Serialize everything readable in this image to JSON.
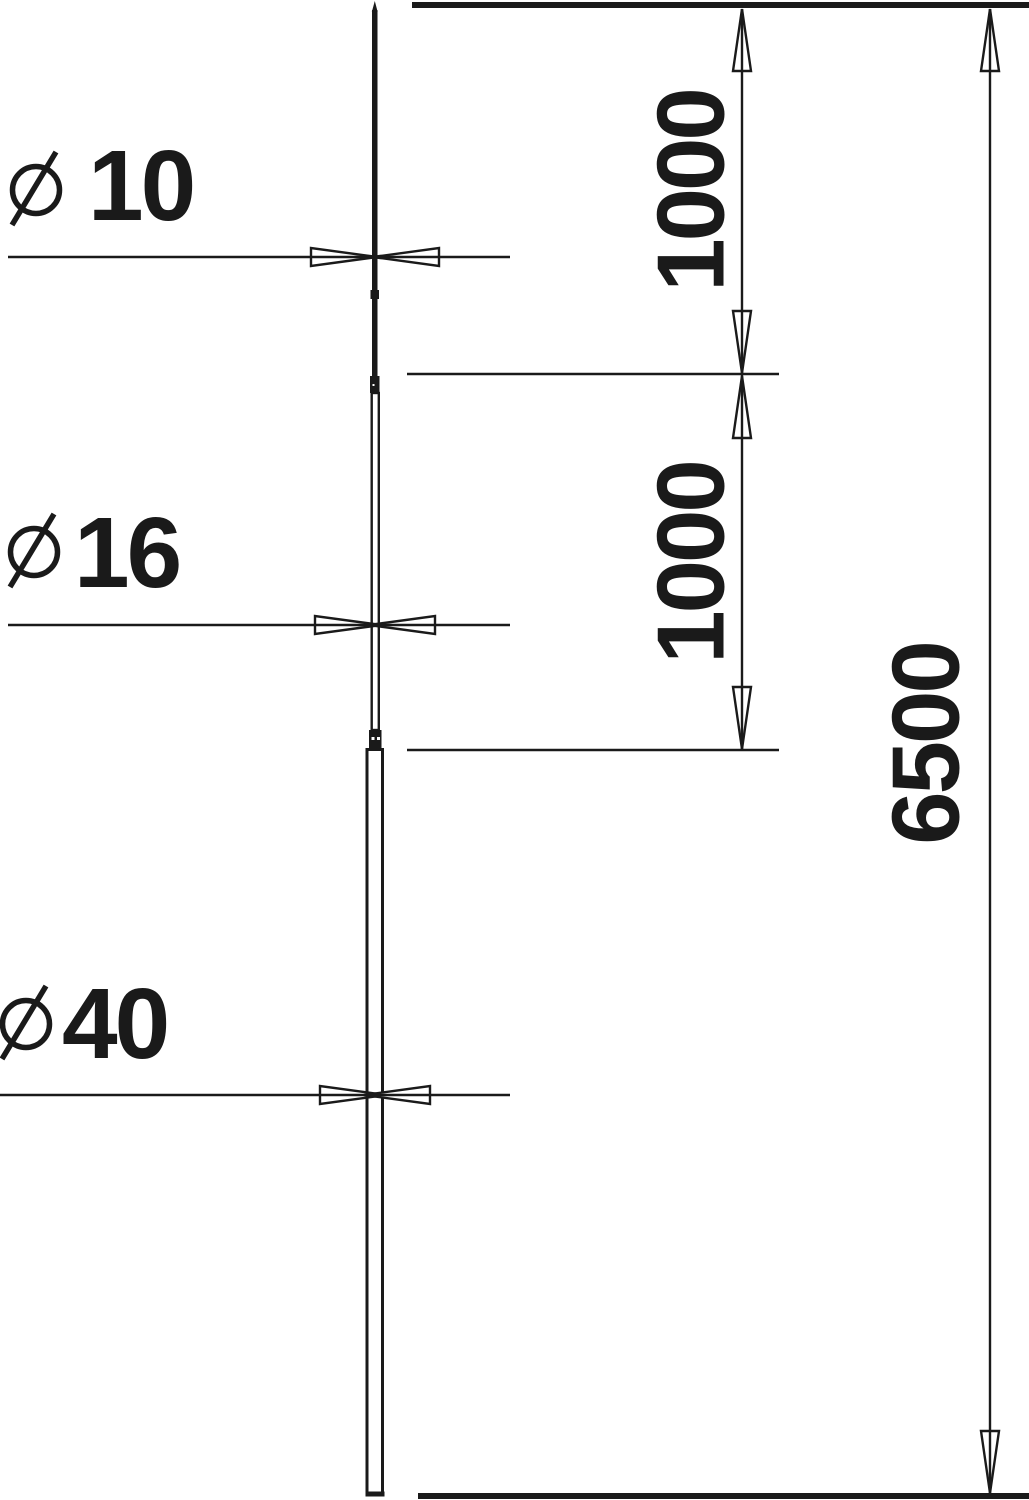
{
  "drawing": {
    "diameter_symbol": "⌀",
    "labels": {
      "dia_top": "10",
      "dia_mid": "16",
      "dia_bot": "40",
      "len_top": "1000",
      "len_mid": "1000",
      "len_total": "6500"
    },
    "colors": {
      "line": "#1a1a1a",
      "background": "#ffffff"
    }
  }
}
